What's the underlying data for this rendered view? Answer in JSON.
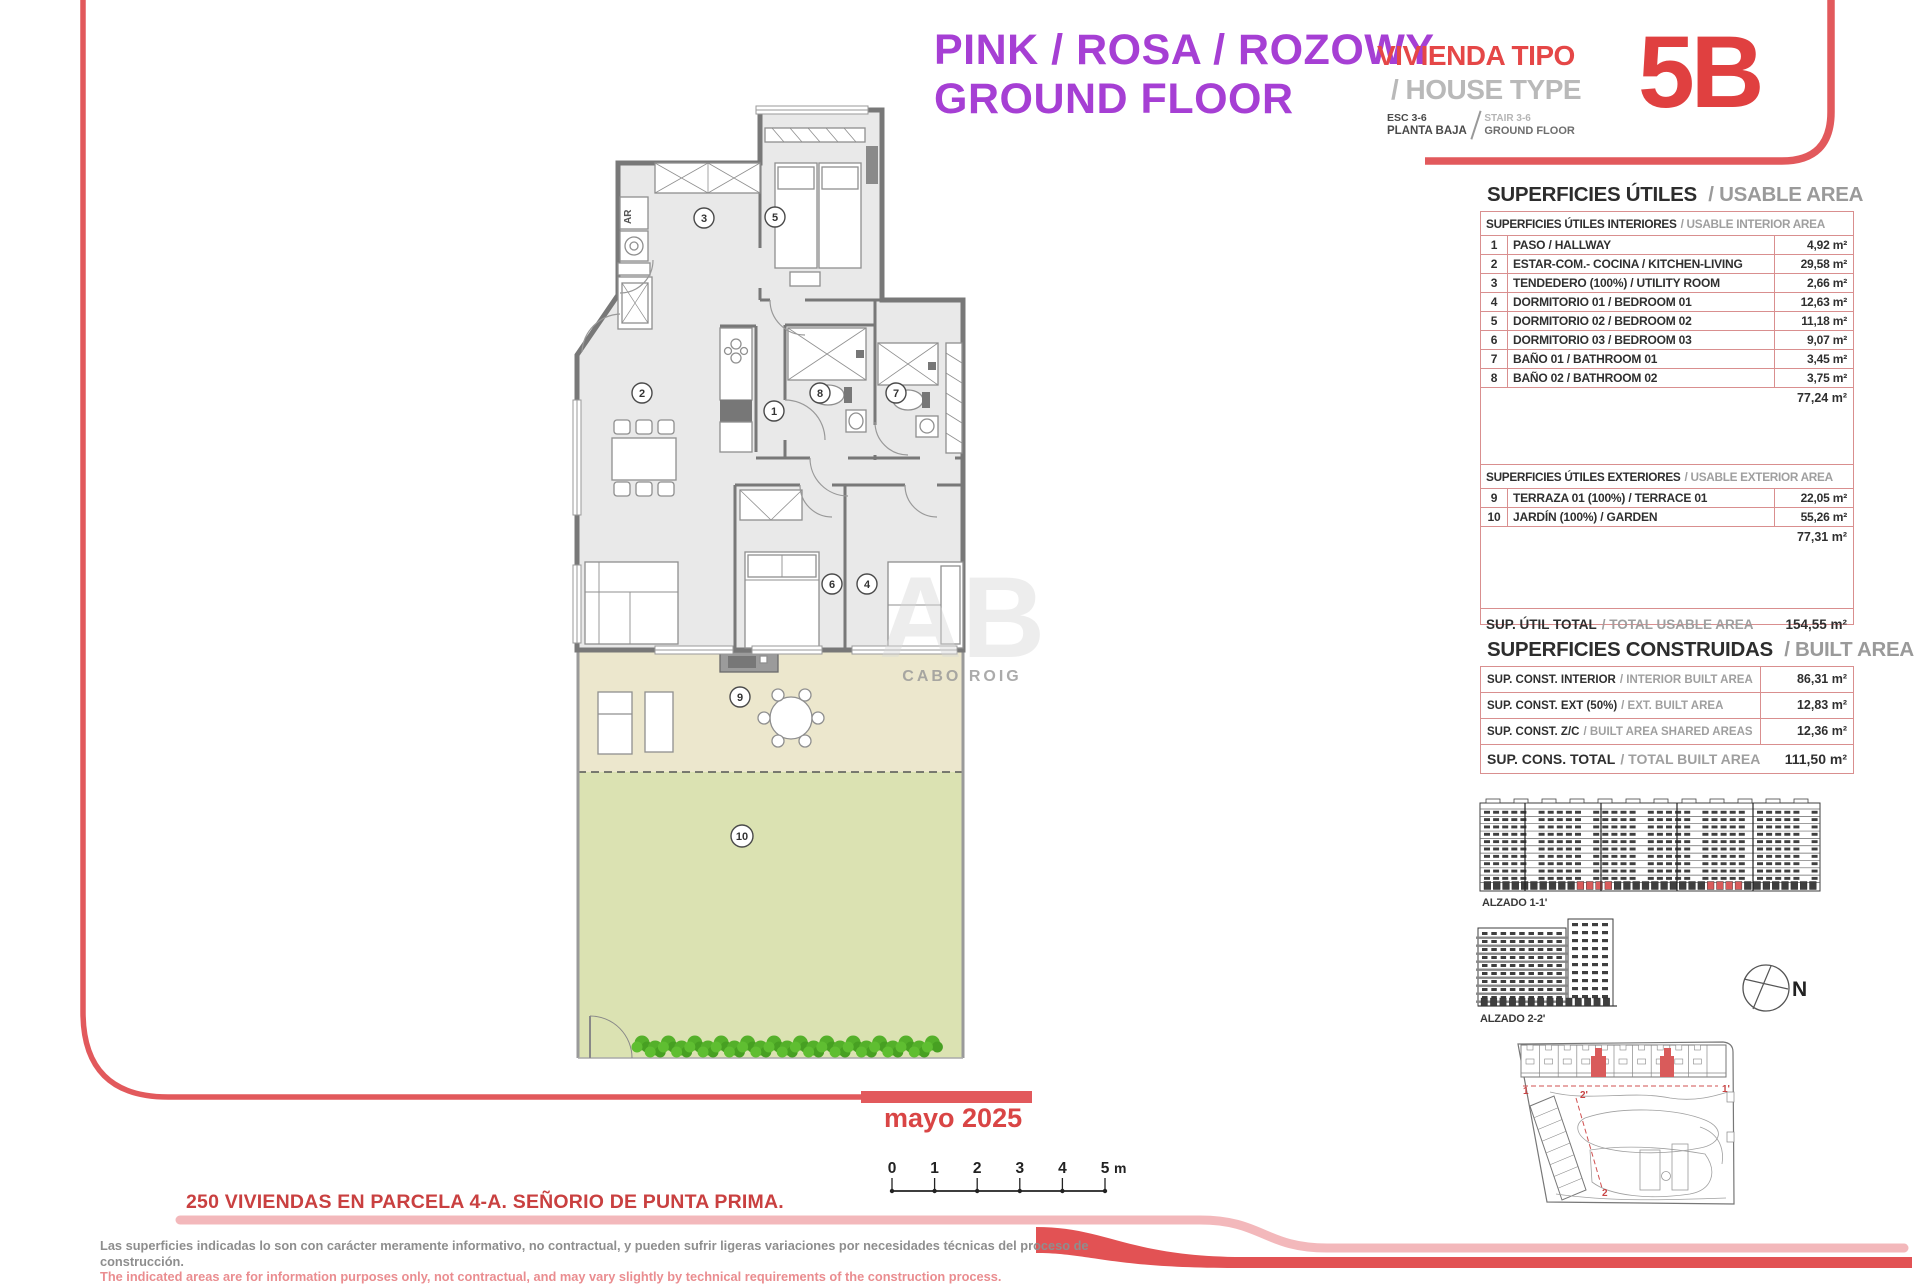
{
  "colors": {
    "accent_red": "#e04b4b",
    "frame_red": "#e2595c",
    "purple": "#a63fd4",
    "gray_label": "#b9b9b9",
    "table_border": "#d98f8f",
    "terrace": "#ece7cd",
    "garden": "#dbe2b2",
    "bush_green": "#55b22a",
    "unit_highlight": "#d95b5b",
    "band_pink": "#f3b8bb"
  },
  "header": {
    "title_line1": "PINK / ROSA / ROZOWY",
    "title_line2": "GROUND FLOOR",
    "vivienda_tipo": "VIVIENDA TIPO",
    "house_type": "/ HOUSE TYPE",
    "esc": "ESC 3-6",
    "planta_baja": "PLANTA BAJA",
    "stair": "STAIR 3-6",
    "ground_floor": "GROUND FLOOR",
    "unit_code": "5B"
  },
  "usable_area": {
    "title_es": "SUPERFICIES ÚTILES",
    "title_en": "/ USABLE AREA",
    "interior_header_es": "SUPERFICIES ÚTILES INTERIORES",
    "interior_header_en": "/ USABLE INTERIOR AREA",
    "interior_rows": [
      {
        "num": "1",
        "label": "PASO / HALLWAY",
        "value": "4,92 m²"
      },
      {
        "num": "2",
        "label": "ESTAR-COM.- COCINA / KITCHEN-LIVING",
        "value": "29,58 m²"
      },
      {
        "num": "3",
        "label": "TENDEDERO (100%) / UTILITY ROOM",
        "value": "2,66 m²"
      },
      {
        "num": "4",
        "label": "DORMITORIO 01 / BEDROOM 01",
        "value": "12,63 m²"
      },
      {
        "num": "5",
        "label": "DORMITORIO 02 / BEDROOM 02",
        "value": "11,18 m²"
      },
      {
        "num": "6",
        "label": "DORMITORIO 03 / BEDROOM 03",
        "value": "9,07 m²"
      },
      {
        "num": "7",
        "label": "BAÑO 01 / BATHROOM 01",
        "value": "3,45 m²"
      },
      {
        "num": "8",
        "label": "BAÑO 02 / BATHROOM 02",
        "value": "3,75 m²"
      }
    ],
    "interior_subtotal": "77,24 m²",
    "exterior_header_es": "SUPERFICIES ÚTILES EXTERIORES",
    "exterior_header_en": "/ USABLE EXTERIOR AREA",
    "exterior_rows": [
      {
        "num": "9",
        "label": "TERRAZA 01 (100%) / TERRACE 01",
        "value": "22,05 m²"
      },
      {
        "num": "10",
        "label": "JARDÍN (100%) / GARDEN",
        "value": "55,26 m²"
      }
    ],
    "exterior_subtotal": "77,31 m²",
    "total_label_es": "SUP. ÚTIL TOTAL",
    "total_label_en": "/ TOTAL USABLE AREA",
    "total_value": "154,55 m²"
  },
  "built_area": {
    "title_es": "SUPERFICIES CONSTRUIDAS",
    "title_en": "/ BUILT AREA",
    "rows": [
      {
        "label_es": "SUP. CONST. INTERIOR",
        "label_en": "/ INTERIOR BUILT AREA",
        "value": "86,31 m²"
      },
      {
        "label_es": "SUP. CONST. EXT (50%)",
        "label_en": "/ EXT. BUILT AREA",
        "value": "12,83 m²"
      },
      {
        "label_es": "SUP. CONST. Z/C",
        "label_en": "/ BUILT AREA SHARED AREAS",
        "value": "12,36 m²"
      }
    ],
    "total_label_es": "SUP. CONS. TOTAL",
    "total_label_en": "/ TOTAL BUILT AREA",
    "total_value": "111,50 m²"
  },
  "plan": {
    "ar_label": "AR",
    "rooms": [
      {
        "num": "1"
      },
      {
        "num": "2"
      },
      {
        "num": "3"
      },
      {
        "num": "4"
      },
      {
        "num": "5"
      },
      {
        "num": "6"
      },
      {
        "num": "7"
      },
      {
        "num": "8"
      },
      {
        "num": "9"
      },
      {
        "num": "10"
      }
    ]
  },
  "elevations": {
    "alzado1": "ALZADO 1-1'",
    "alzado2": "ALZADO 2-2'"
  },
  "compass": {
    "north_label": "N"
  },
  "site_plan": {
    "label_1": "1",
    "label_1p": "1'",
    "label_2": "2",
    "label_2p": "2'"
  },
  "date_label": "mayo 2025",
  "scale_bar": {
    "ticks": [
      "0",
      "1",
      "2",
      "3",
      "4",
      "5"
    ],
    "unit": "m"
  },
  "project_title": "250 VIVIENDAS EN PARCELA 4-A. SEÑORIO DE PUNTA PRIMA.",
  "disclaimer_es": "Las superficies indicadas lo son con carácter meramente informativo, no contractual, y pueden sufrir ligeras variaciones por necesidades técnicas del proceso de construcción.",
  "disclaimer_en": "The indicated areas are for information purposes only, not contractual, and may vary slightly by technical requirements of the construction process.",
  "watermark": {
    "letters": "AB",
    "text": "CABO ROIG"
  }
}
